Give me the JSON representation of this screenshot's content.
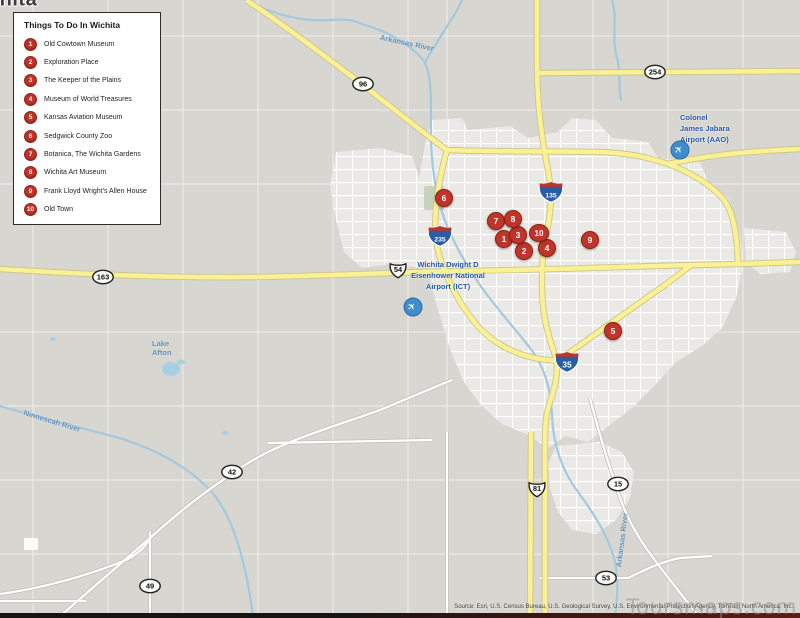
{
  "legend": {
    "title": "Things To Do In Wichita",
    "items": [
      {
        "num": "1",
        "label": "Old Cowtown Museum"
      },
      {
        "num": "2",
        "label": "Exploration Place"
      },
      {
        "num": "3",
        "label": "The Keeper of the Plains"
      },
      {
        "num": "4",
        "label": "Museum of World Treasures"
      },
      {
        "num": "5",
        "label": "Kansas Aviation Museum"
      },
      {
        "num": "6",
        "label": "Sedgwick County Zoo"
      },
      {
        "num": "7",
        "label": "Botanica, The Wichita Gardens"
      },
      {
        "num": "8",
        "label": "Wichita Art Museum"
      },
      {
        "num": "9",
        "label": "Frank Lloyd Wright's Allen House"
      },
      {
        "num": "10",
        "label": "Old Town"
      }
    ]
  },
  "map": {
    "city_label": "Wichita",
    "markers": [
      {
        "num": "1",
        "x": 504,
        "y": 239
      },
      {
        "num": "2",
        "x": 524,
        "y": 251
      },
      {
        "num": "3",
        "x": 518,
        "y": 235
      },
      {
        "num": "4",
        "x": 547,
        "y": 248
      },
      {
        "num": "5",
        "x": 613,
        "y": 331
      },
      {
        "num": "6",
        "x": 444,
        "y": 198
      },
      {
        "num": "7",
        "x": 496,
        "y": 221
      },
      {
        "num": "8",
        "x": 513,
        "y": 219
      },
      {
        "num": "9",
        "x": 590,
        "y": 240
      },
      {
        "num": "10",
        "x": 539,
        "y": 233
      }
    ],
    "shields": [
      {
        "type": "oval",
        "label": "96",
        "x": 363,
        "y": 84
      },
      {
        "type": "oval",
        "label": "254",
        "x": 655,
        "y": 72
      },
      {
        "type": "oval",
        "label": "163",
        "x": 103,
        "y": 277
      },
      {
        "type": "us",
        "label": "54",
        "x": 398,
        "y": 270
      },
      {
        "type": "oval",
        "label": "42",
        "x": 232,
        "y": 472
      },
      {
        "type": "us",
        "label": "81",
        "x": 537,
        "y": 489
      },
      {
        "type": "oval",
        "label": "15",
        "x": 618,
        "y": 484
      },
      {
        "type": "oval",
        "label": "49",
        "x": 150,
        "y": 586
      },
      {
        "type": "oval",
        "label": "53",
        "x": 606,
        "y": 578
      },
      {
        "type": "interstate",
        "label": "135",
        "x": 551,
        "y": 192
      },
      {
        "type": "interstate",
        "label": "235",
        "x": 440,
        "y": 236
      },
      {
        "type": "interstate",
        "label": "35",
        "x": 567,
        "y": 362
      }
    ],
    "airports": [
      {
        "id": "ict",
        "lines": [
          "Wichita Dwight D",
          "Eisenhower National",
          "Airport (ICT)"
        ],
        "label_x": 448,
        "label_y": 259,
        "icon_x": 413,
        "icon_y": 307,
        "align": "center"
      },
      {
        "id": "aao",
        "lines": [
          "Colonel",
          "James Jabara",
          "Airport (AAO)"
        ],
        "label_x": 680,
        "label_y": 112,
        "icon_x": 680,
        "icon_y": 150,
        "align": "left"
      }
    ],
    "water_labels": [
      {
        "text": "Arkansas River",
        "x": 407,
        "y": 43,
        "rot": 12,
        "wrap": false
      },
      {
        "text": "Lake Afton",
        "x": 166,
        "y": 348,
        "rot": 0,
        "wrap": true
      },
      {
        "text": "Ninnescah River",
        "x": 52,
        "y": 421,
        "rot": 17,
        "wrap": false
      },
      {
        "text": "Arkansas River",
        "x": 622,
        "y": 540,
        "rot": -83,
        "wrap": false
      }
    ],
    "attribution": "Source: Esri, U.S. Census Bureau, U.S. Geological Survey, U.S. Environmental Protection Agency, TomTom North America, Inc.",
    "watermark": "Toursmaps.com"
  },
  "colors": {
    "marker_red": "#bf3227",
    "highway_yellow": "#f9f193",
    "water_blue": "#a3c9de",
    "airport_blue": "#2456a8",
    "interstate_blue": "#2a5ca8",
    "background": "#d8d6d1"
  }
}
